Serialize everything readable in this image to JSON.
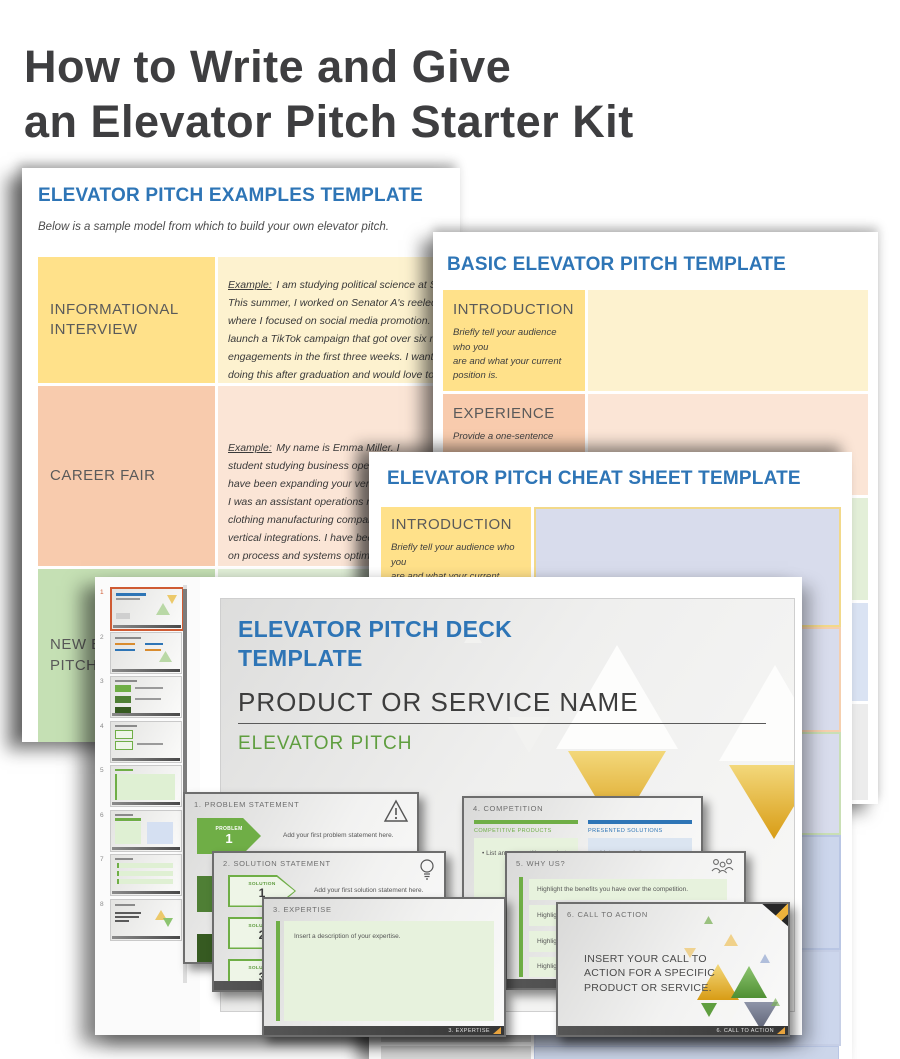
{
  "page": {
    "title_line1": "How to Write and Give",
    "title_line2": "an Elevator Pitch Starter Kit"
  },
  "colors": {
    "accent_blue": "#2e75b6",
    "accent_green": "#6fae46",
    "selected_thumb_border": "#cf5b33",
    "gold": "#e2a73e",
    "label_yellow": "#ffe18a",
    "label_peach": "#f8cbad",
    "label_green": "#c5e0b4"
  },
  "examples_doc": {
    "title": "ELEVATOR PITCH EXAMPLES TEMPLATE",
    "subtitle": "Below is a sample model from which to build your own elevator pitch.",
    "example_label": "Example:",
    "rows": [
      {
        "label": "INFORMATIONAL INTERVIEW",
        "text": "I am studying political science at State\nThis summer, I worked on Senator A's reelection c\nwhere I focused on social media promotion. I help\nlaunch a TikTok campaign that got over six million\nengagements in the first three weeks. I want to co\ndoing this after graduation and would love to talk\nabout your work. I am really drawn to the social m\ncampaigns your company has spearheaded, esp\nones for Governor B and Congresswoman C."
      },
      {
        "label": "CAREER FAIR",
        "text": "My name is Emma Miller. I\nstudent studying business operation\nhave been expanding your vertical\nI was an assistant operations manag\nclothing manufacturing company,\nvertical integrations. I have been fo\non process and systems optimizatio\ninternships and jobs where I can pu"
      },
      {
        "label": "NEW EMPLOYEE PITCH",
        "text": ""
      }
    ]
  },
  "basic_doc": {
    "title": "BASIC ELEVATOR PITCH TEMPLATE",
    "rows": [
      {
        "label": "INTRODUCTION",
        "desc": "Briefly tell your audience who you\nare and what your current\nposition is."
      },
      {
        "label": "EXPERIENCE",
        "desc": "Provide a one-sentence"
      }
    ]
  },
  "cheat_doc": {
    "title": "ELEVATOR PITCH CHEAT SHEET TEMPLATE",
    "rows": [
      {
        "label": "INTRODUCTION",
        "desc": "Briefly tell your audience who you\nare and what your current\nposition is."
      }
    ]
  },
  "deck": {
    "title_line1": "ELEVATOR PITCH DECK",
    "title_line2": "TEMPLATE",
    "product_name": "PRODUCT OR SERVICE NAME",
    "pitch_label": "ELEVATOR PITCH",
    "thumb_numbers": [
      "1",
      "2",
      "3",
      "4",
      "5",
      "6",
      "7",
      "8"
    ],
    "cards": {
      "problem": {
        "header": "1. PROBLEM STATEMENT",
        "badge_tag": "PROBLEM",
        "badge_nums": [
          "1",
          "2",
          "3"
        ],
        "body": "Add your first problem statement here."
      },
      "solution": {
        "header": "2. SOLUTION STATEMENT",
        "badge_tag": "SOLUTION",
        "badge_nums": [
          "1",
          "2",
          "3"
        ],
        "body": "Add your first solution statement here."
      },
      "expertise": {
        "header": "3. EXPERTISE",
        "body": "Insert a description of your expertise.",
        "footer": "3. EXPERTISE"
      },
      "competition": {
        "header": "4. COMPETITION",
        "left_label": "COMPETITIVE PRODUCTS",
        "left_bullet": "•  List any competitive products.",
        "right_label": "PRESENTED SOLUTIONS",
        "right_bullet": "•  List your solutions."
      },
      "why_us": {
        "header": "5. WHY US?",
        "row1": "Highlight the benefits you have over the competition.",
        "row2": "Highlight",
        "row3": "Highlight",
        "row4": "Highlight"
      },
      "cta": {
        "header": "6. CALL TO ACTION",
        "body": "INSERT YOUR CALL TO ACTION FOR A SPECIFIC PRODUCT OR SERVICE.",
        "footer": "6. CALL TO ACTION"
      }
    }
  }
}
